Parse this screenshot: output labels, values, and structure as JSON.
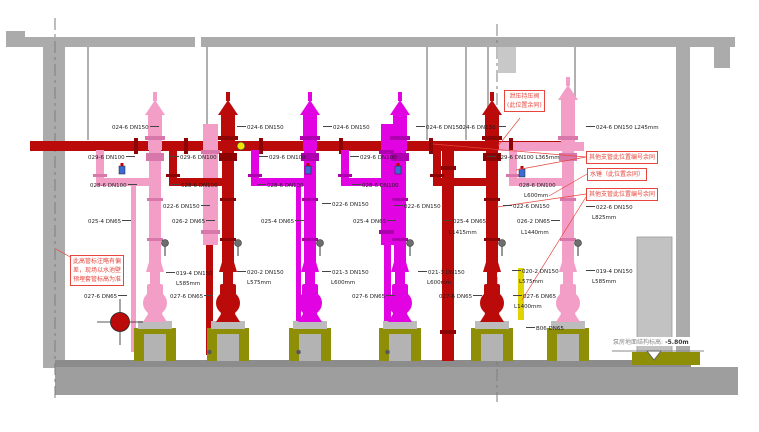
{
  "drawing": {
    "type": "fire-pump-room-piping-elevation",
    "level_marker": {
      "label": "泵房地面结构标高:",
      "value": " -5.80m"
    }
  },
  "colors": {
    "pink": "#f29ec6",
    "pink_deep": "#d878aa",
    "magenta": "#e203e2",
    "magenta_deep": "#ae00ae",
    "dark_red": "#bb0a0a",
    "dark_red_deep": "#8c0404",
    "olive": "#8f8f07",
    "yellow": "#e0d400",
    "structure_gray": "#ababab",
    "floor_gray": "#9e9e9e",
    "floor_edge_gray": "#8c8c8c",
    "annotation_red": "#e8453c"
  },
  "labels": [
    {
      "x": 112,
      "y": 126,
      "text": "024-6 DN150",
      "lead": "r"
    },
    {
      "x": 88,
      "y": 156,
      "text": "029-6 DN100",
      "lead": "r"
    },
    {
      "x": 90,
      "y": 184,
      "text": "028-6 DN100",
      "lead": "r"
    },
    {
      "x": 88,
      "y": 220,
      "text": "025-4 DN65",
      "lead": "r"
    },
    {
      "x": 84,
      "y": 295,
      "text": "027-6 DN65",
      "lead": "r"
    },
    {
      "x": 166,
      "y": 272,
      "text": "019-4 DN150",
      "lead": "l"
    },
    {
      "x": 176,
      "y": 282,
      "text": "L585mm"
    },
    {
      "x": 237,
      "y": 126,
      "text": "024-6 DN150",
      "lead": "l"
    },
    {
      "x": 170,
      "y": 156,
      "text": "029-6 DN100",
      "lead": "l"
    },
    {
      "x": 171,
      "y": 184,
      "text": "028-6 DN100",
      "lead": "l"
    },
    {
      "x": 163,
      "y": 205,
      "text": "022-6 DN150",
      "lead": "r"
    },
    {
      "x": 172,
      "y": 220,
      "text": "026-2 DN65",
      "lead": "r"
    },
    {
      "x": 237,
      "y": 271,
      "text": "020-2 DN150",
      "lead": "l"
    },
    {
      "x": 247,
      "y": 281,
      "text": "L575mm"
    },
    {
      "x": 170,
      "y": 295,
      "text": "027-6 DN65",
      "lead": "r"
    },
    {
      "x": 323,
      "y": 126,
      "text": "024-6 DN150",
      "lead": "l"
    },
    {
      "x": 259,
      "y": 156,
      "text": "029-6 DN100",
      "lead": "l"
    },
    {
      "x": 257,
      "y": 184,
      "text": "028-6 DN100",
      "lead": "l"
    },
    {
      "x": 322,
      "y": 203,
      "text": "022-6 DN150",
      "lead": "l"
    },
    {
      "x": 261,
      "y": 220,
      "text": "025-4 DN65",
      "lead": "r"
    },
    {
      "x": 322,
      "y": 271,
      "text": "021-3 DN150",
      "lead": "l"
    },
    {
      "x": 331,
      "y": 281,
      "text": "L600mm"
    },
    {
      "x": 352,
      "y": 295,
      "text": "027-6 DN65",
      "lead": "r"
    },
    {
      "x": 416,
      "y": 126,
      "text": "024-6 DN150",
      "lead": "l"
    },
    {
      "x": 350,
      "y": 156,
      "text": "029-6 DN100",
      "lead": "l"
    },
    {
      "x": 352,
      "y": 184,
      "text": "028-6 DN100",
      "lead": "l"
    },
    {
      "x": 394,
      "y": 205,
      "text": "022-6 DN150",
      "lead": "l"
    },
    {
      "x": 353,
      "y": 220,
      "text": "025-4 DN65",
      "lead": "r"
    },
    {
      "x": 418,
      "y": 271,
      "text": "021-3 DN150",
      "lead": "l"
    },
    {
      "x": 427,
      "y": 281,
      "text": "L600mm"
    },
    {
      "x": 439,
      "y": 295,
      "text": "027-6 DN65",
      "lead": "r"
    },
    {
      "x": 459,
      "y": 126,
      "text": "024-6 DN150",
      "lead": "r"
    },
    {
      "x": 487,
      "y": 156,
      "text": "029-6 DN100 L365mm",
      "lead": "l"
    },
    {
      "x": 519,
      "y": 184,
      "text": "028-6 DN100"
    },
    {
      "x": 524,
      "y": 194,
      "text": "L600mm"
    },
    {
      "x": 503,
      "y": 205,
      "text": "022-6 DN150",
      "lead": "l"
    },
    {
      "x": 443,
      "y": 220,
      "text": "025-4 DN65",
      "lead": "l"
    },
    {
      "x": 449,
      "y": 231,
      "text": "L1415mm"
    },
    {
      "x": 517,
      "y": 220,
      "text": "026-2 DN65",
      "lead": "r"
    },
    {
      "x": 521,
      "y": 231,
      "text": "L1440mm"
    },
    {
      "x": 512,
      "y": 270,
      "text": "020-2 DN150",
      "lead": "l"
    },
    {
      "x": 519,
      "y": 280,
      "text": "L575mm"
    },
    {
      "x": 513,
      "y": 295,
      "text": "027-6 DN65",
      "lead": "l"
    },
    {
      "x": 514,
      "y": 305,
      "text": "L1400mm"
    },
    {
      "x": 526,
      "y": 327,
      "text": "B06 DN65",
      "lead": "l"
    },
    {
      "x": 586,
      "y": 126,
      "text": "024-6 DN150 L245mm",
      "lead": "l"
    },
    {
      "x": 586,
      "y": 206,
      "text": "022-6 DN150",
      "lead": "l"
    },
    {
      "x": 592,
      "y": 216,
      "text": "L825mm"
    },
    {
      "x": 586,
      "y": 270,
      "text": "019-4 DN150",
      "lead": "l"
    },
    {
      "x": 592,
      "y": 280,
      "text": "L585mm"
    }
  ],
  "callouts": [
    {
      "x": 504,
      "y": 90,
      "lines": [
        "泄压持压阀",
        "(此位置余同)"
      ]
    },
    {
      "x": 586,
      "y": 151,
      "lines": [
        "其他支管此位置编号余同"
      ]
    },
    {
      "x": 587,
      "y": 168,
      "lines": [
        "水锤（此位置余同）"
      ]
    },
    {
      "x": 586,
      "y": 188,
      "lines": [
        "其他支管此位置编号余同"
      ]
    },
    {
      "x": 70,
      "y": 255,
      "lines": [
        "此高管标注略有偏",
        "差，现场以水池壁",
        "预埋套管标高为准"
      ]
    }
  ],
  "pumps": [
    {
      "id": "1",
      "cx": 155,
      "color": "pink"
    },
    {
      "id": "2",
      "cx": 228,
      "color": "dark_red"
    },
    {
      "id": "3",
      "cx": 310,
      "color": "magenta"
    },
    {
      "id": "4",
      "cx": 400,
      "color": "magenta"
    },
    {
      "id": "5",
      "cx": 492,
      "color": "dark_red"
    },
    {
      "id": "6",
      "cx": 568,
      "color": "pink",
      "tall": true
    }
  ],
  "pipes": [
    {
      "x": 30,
      "y": 141,
      "w": 533,
      "h": 10,
      "color": "dark_red"
    },
    {
      "x": 498,
      "y": 142,
      "w": 86,
      "h": 9,
      "color": "pink"
    },
    {
      "x": 203,
      "y": 124,
      "w": 15,
      "h": 121,
      "color": "pink"
    },
    {
      "x": 206,
      "y": 245,
      "w": 7,
      "h": 110,
      "color": "dark_red"
    },
    {
      "x": 381,
      "y": 124,
      "w": 15,
      "h": 121,
      "color": "magenta"
    },
    {
      "x": 384,
      "y": 245,
      "w": 7,
      "h": 110,
      "color": "magenta"
    },
    {
      "x": 131,
      "y": 186,
      "w": 5,
      "h": 166,
      "color": "pink"
    },
    {
      "x": 296,
      "y": 186,
      "w": 5,
      "h": 166,
      "color": "magenta"
    },
    {
      "x": 442,
      "y": 150,
      "w": 12,
      "h": 211,
      "color": "dark_red"
    },
    {
      "x": 518,
      "y": 268,
      "w": 6,
      "h": 52,
      "color": "yellow"
    },
    {
      "x": 134,
      "y": 138,
      "w": 4,
      "h": 16,
      "color": "dark_red_deep"
    },
    {
      "x": 184,
      "y": 138,
      "w": 4,
      "h": 16,
      "color": "dark_red_deep"
    },
    {
      "x": 259,
      "y": 138,
      "w": 4,
      "h": 16,
      "color": "dark_red_deep"
    },
    {
      "x": 339,
      "y": 138,
      "w": 4,
      "h": 16,
      "color": "dark_red_deep"
    },
    {
      "x": 429,
      "y": 138,
      "w": 4,
      "h": 16,
      "color": "dark_red_deep"
    },
    {
      "x": 509,
      "y": 138,
      "w": 4,
      "h": 16,
      "color": "dark_red_deep"
    },
    {
      "x": 201,
      "y": 150,
      "w": 19,
      "h": 4,
      "color": "pink_deep"
    },
    {
      "x": 201,
      "y": 230,
      "w": 19,
      "h": 4,
      "color": "pink_deep"
    },
    {
      "x": 379,
      "y": 150,
      "w": 19,
      "h": 4,
      "color": "magenta_deep"
    },
    {
      "x": 379,
      "y": 230,
      "w": 19,
      "h": 4,
      "color": "magenta_deep"
    },
    {
      "x": 440,
      "y": 166,
      "w": 16,
      "h": 4,
      "color": "dark_red_deep"
    },
    {
      "x": 440,
      "y": 330,
      "w": 16,
      "h": 4,
      "color": "dark_red_deep"
    }
  ],
  "leaders": [
    [
      520,
      118,
      498,
      146
    ],
    [
      586,
      157,
      433,
      144
    ],
    [
      586,
      157,
      516,
      170
    ],
    [
      587,
      174,
      549,
      196
    ],
    [
      586,
      194,
      497,
      207
    ],
    [
      586,
      197,
      522,
      300
    ],
    [
      72,
      258,
      56,
      249
    ]
  ]
}
